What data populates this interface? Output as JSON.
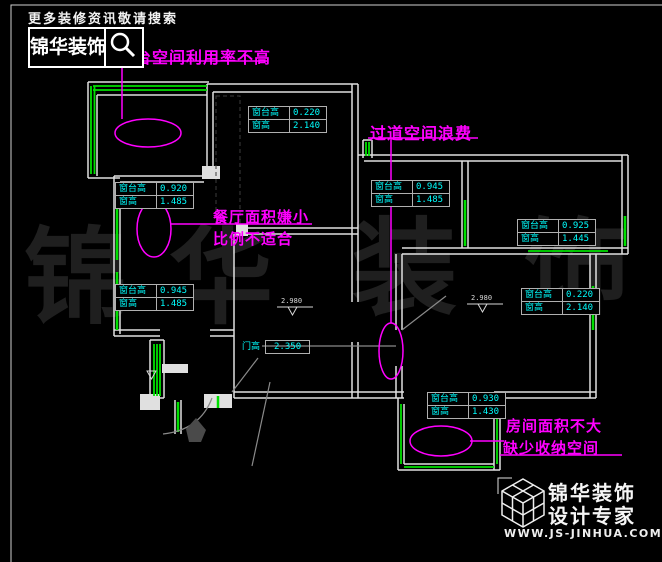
{
  "header": {
    "tagline": "更多装修资讯敬请搜索",
    "brand": "锦华装饰"
  },
  "annotations": {
    "balcony": "阳台空间利用率不高",
    "dining_1": "餐厅面积嫌小",
    "dining_2": "比例不适合",
    "corridor": "过道空间浪费",
    "bedroom_1": "房间面积不大",
    "bedroom_2": "缺少收纳空间"
  },
  "labels": {
    "sill": "窗台高",
    "window": "窗高"
  },
  "tables": {
    "t1": {
      "sill": "0.220",
      "window": "2.140"
    },
    "t2": {
      "sill": "0.920",
      "window": "1.485"
    },
    "t3": {
      "sill": "0.945",
      "window": "1.485"
    },
    "t4": {
      "sill": "0.925",
      "window": "1.445"
    },
    "t5": {
      "sill": "0.945",
      "window": "1.485"
    },
    "t6": {
      "sill": "0.220",
      "window": "2.140"
    },
    "t7": {
      "sill": "0.930",
      "window": "1.430"
    }
  },
  "door": {
    "label": "门高",
    "value": "2.350"
  },
  "elevations": {
    "m1": "2.980",
    "m2": "2.980"
  },
  "watermark": {
    "c1": "锦",
    "c2": "华",
    "c3": "装",
    "c4": "饰"
  },
  "footer": {
    "brand": "锦华装饰",
    "subtitle": "设计专家",
    "url": "WWW.JS-JINHUA.COM"
  },
  "colors": {
    "annotation": "#ff00ff",
    "table_text": "#00ffff",
    "window_green": "#00e000",
    "wall_white": "#e0e0e0",
    "background": "#000000"
  }
}
